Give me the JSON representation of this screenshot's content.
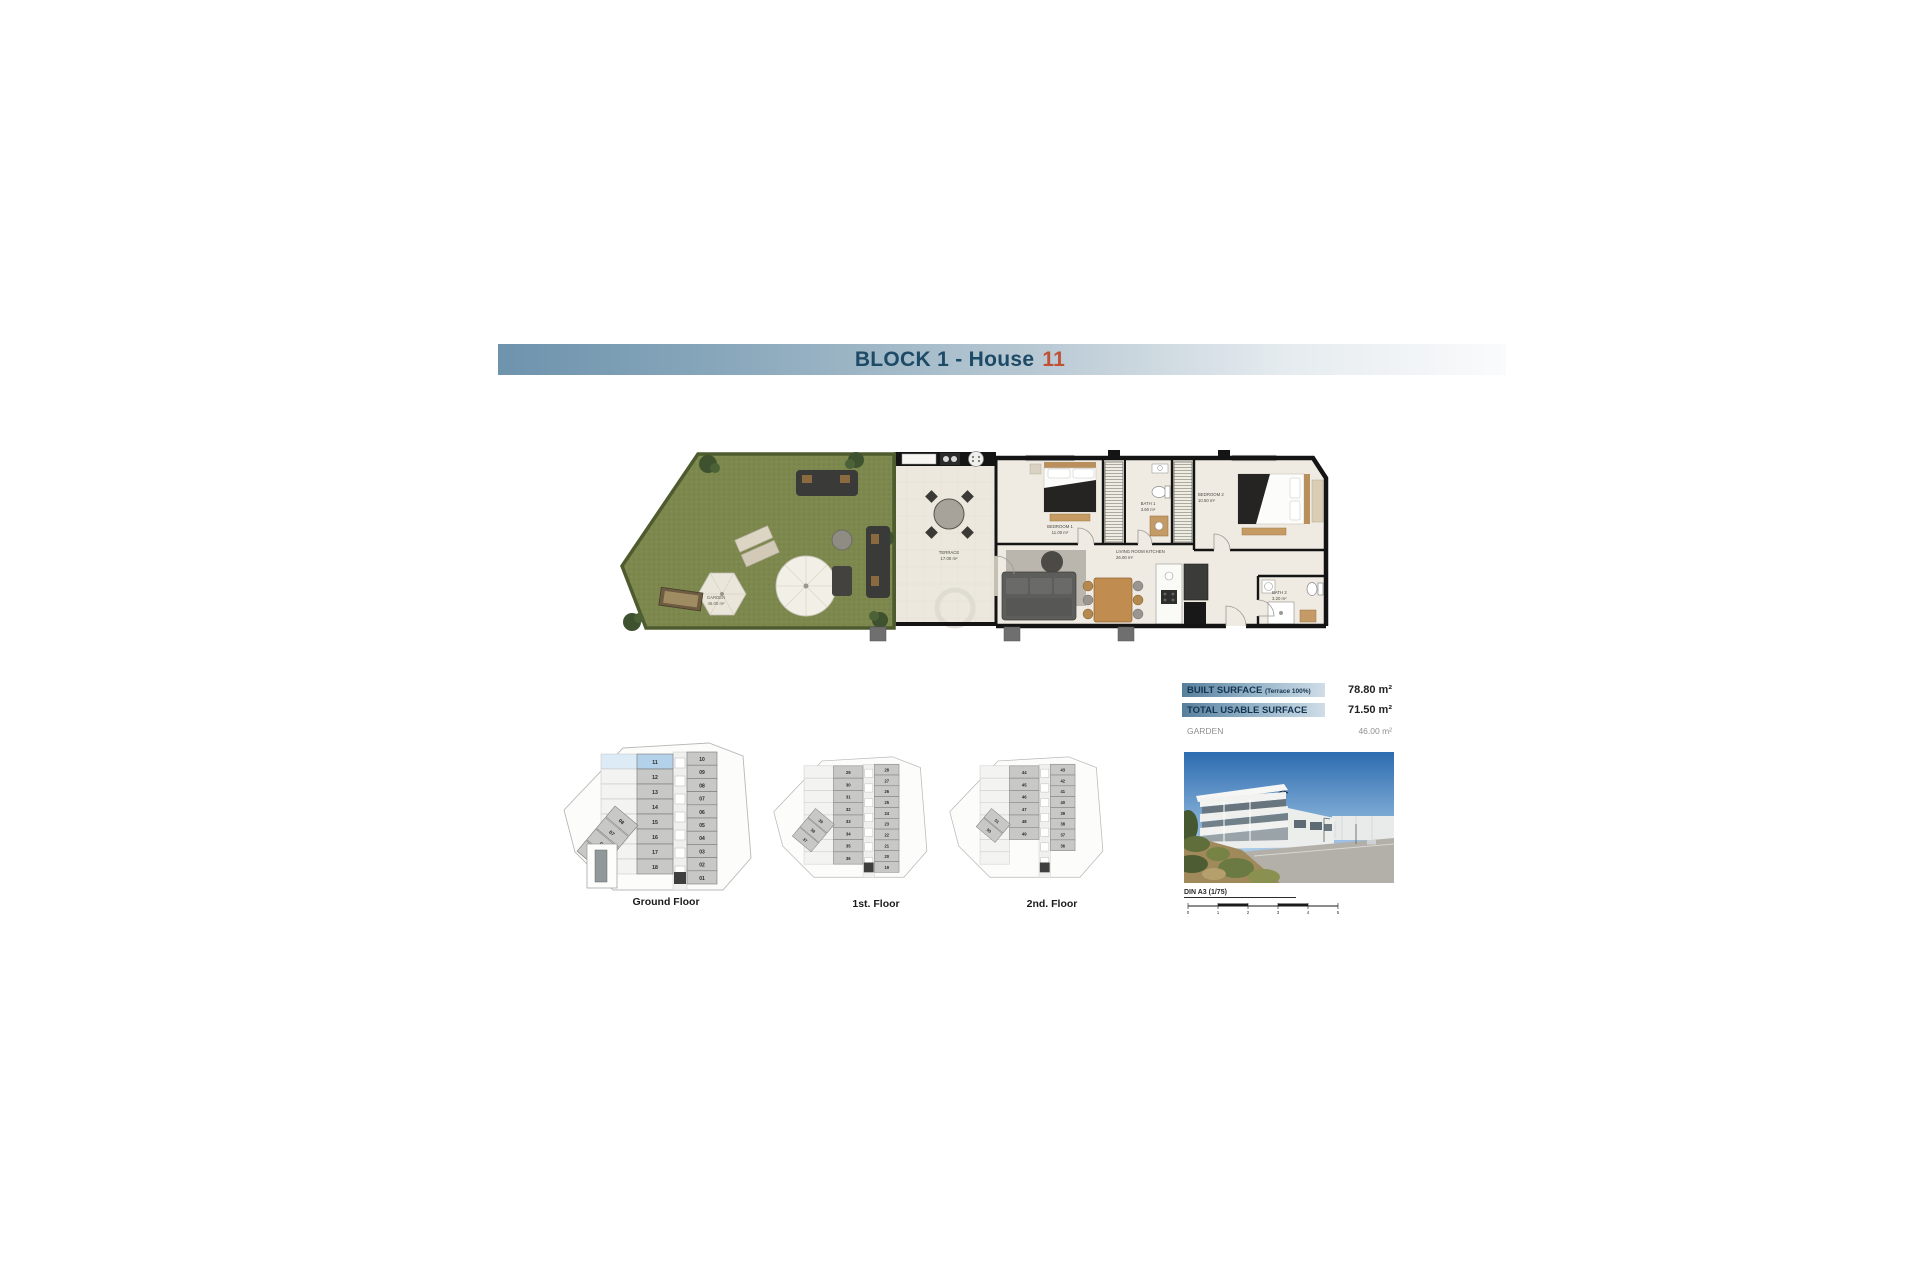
{
  "banner": {
    "title": "BLOCK 1 - House",
    "number": "11"
  },
  "rooms": {
    "garden": {
      "name": "GARDEN",
      "area": "46.00 m²"
    },
    "terrace": {
      "name": "TERRACE",
      "area": "17.00 m²"
    },
    "bedroom1": {
      "name": "BEDROOM 1",
      "area": "11.00 m²"
    },
    "bath1": {
      "name": "BATH 1",
      "area": "3.60 m²"
    },
    "bedroom2": {
      "name": "BEDROOM 2",
      "area": "10.50 m²"
    },
    "living": {
      "name": "LIVING ROOM KITCHEN",
      "area": "26.00 m²"
    },
    "bath2": {
      "name": "BATH 2",
      "area": "3.20 m²"
    }
  },
  "summary": {
    "rows": [
      {
        "label": "BUILT SURFACE",
        "note": "(Terrace 100%)",
        "value": "78.80 m²",
        "highlight": true
      },
      {
        "label": "TOTAL USABLE SURFACE",
        "note": "",
        "value": "71.50 m²",
        "highlight": true
      },
      {
        "label": "GARDEN",
        "note": "",
        "value": "46.00 m²",
        "highlight": false
      }
    ]
  },
  "key_plans": [
    {
      "label": "Ground Floor",
      "highlight_unit": "11",
      "pool": true,
      "mid_units": [
        "11",
        "12",
        "13",
        "14",
        "15",
        "16",
        "17",
        "18"
      ],
      "right_units": [
        "10",
        "09",
        "08",
        "07",
        "06",
        "05",
        "04",
        "03",
        "02",
        "01"
      ],
      "strip_units": [
        "08",
        "07",
        "06",
        "05"
      ]
    },
    {
      "label": "1st. Floor",
      "highlight_unit": "",
      "pool": false,
      "mid_units": [
        "29",
        "30",
        "31",
        "32",
        "33",
        "34",
        "35",
        "36"
      ],
      "right_units": [
        "28",
        "27",
        "26",
        "25",
        "24",
        "23",
        "22",
        "21",
        "20",
        "19"
      ],
      "strip_units": [
        "39",
        "38",
        "37"
      ]
    },
    {
      "label": "2nd. Floor",
      "highlight_unit": "",
      "pool": false,
      "mid_units": [
        "44",
        "45",
        "46",
        "47",
        "48",
        "49"
      ],
      "right_units": [
        "43",
        "42",
        "41",
        "40",
        "39",
        "38",
        "37",
        "36"
      ],
      "strip_units": [
        "51",
        "50"
      ]
    }
  ],
  "scale_bar": {
    "label": "DIN A3 (1/75)",
    "ticks": [
      "0",
      "1",
      "2",
      "3",
      "4",
      "5"
    ]
  }
}
